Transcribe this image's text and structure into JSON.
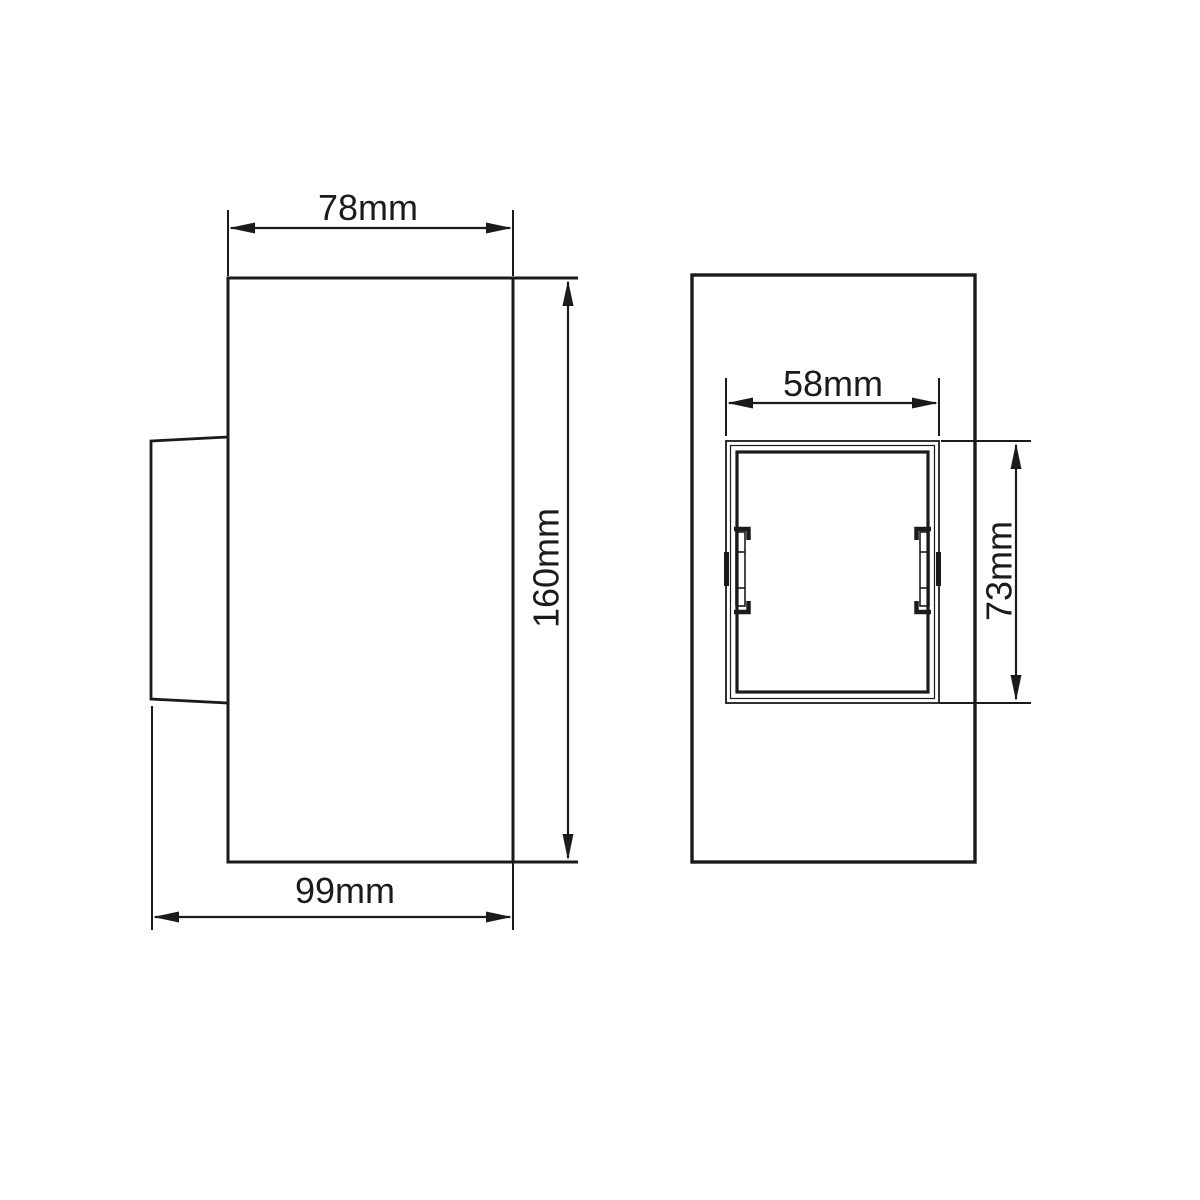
{
  "drawing": {
    "background_color": "#ffffff",
    "line_color": "#1b1b1b",
    "side_view": {
      "width_label": "78mm",
      "height_label": "160mm",
      "depth_label": "99mm"
    },
    "front_view": {
      "opening_width_label": "58mm",
      "opening_height_label": "73mm"
    }
  }
}
